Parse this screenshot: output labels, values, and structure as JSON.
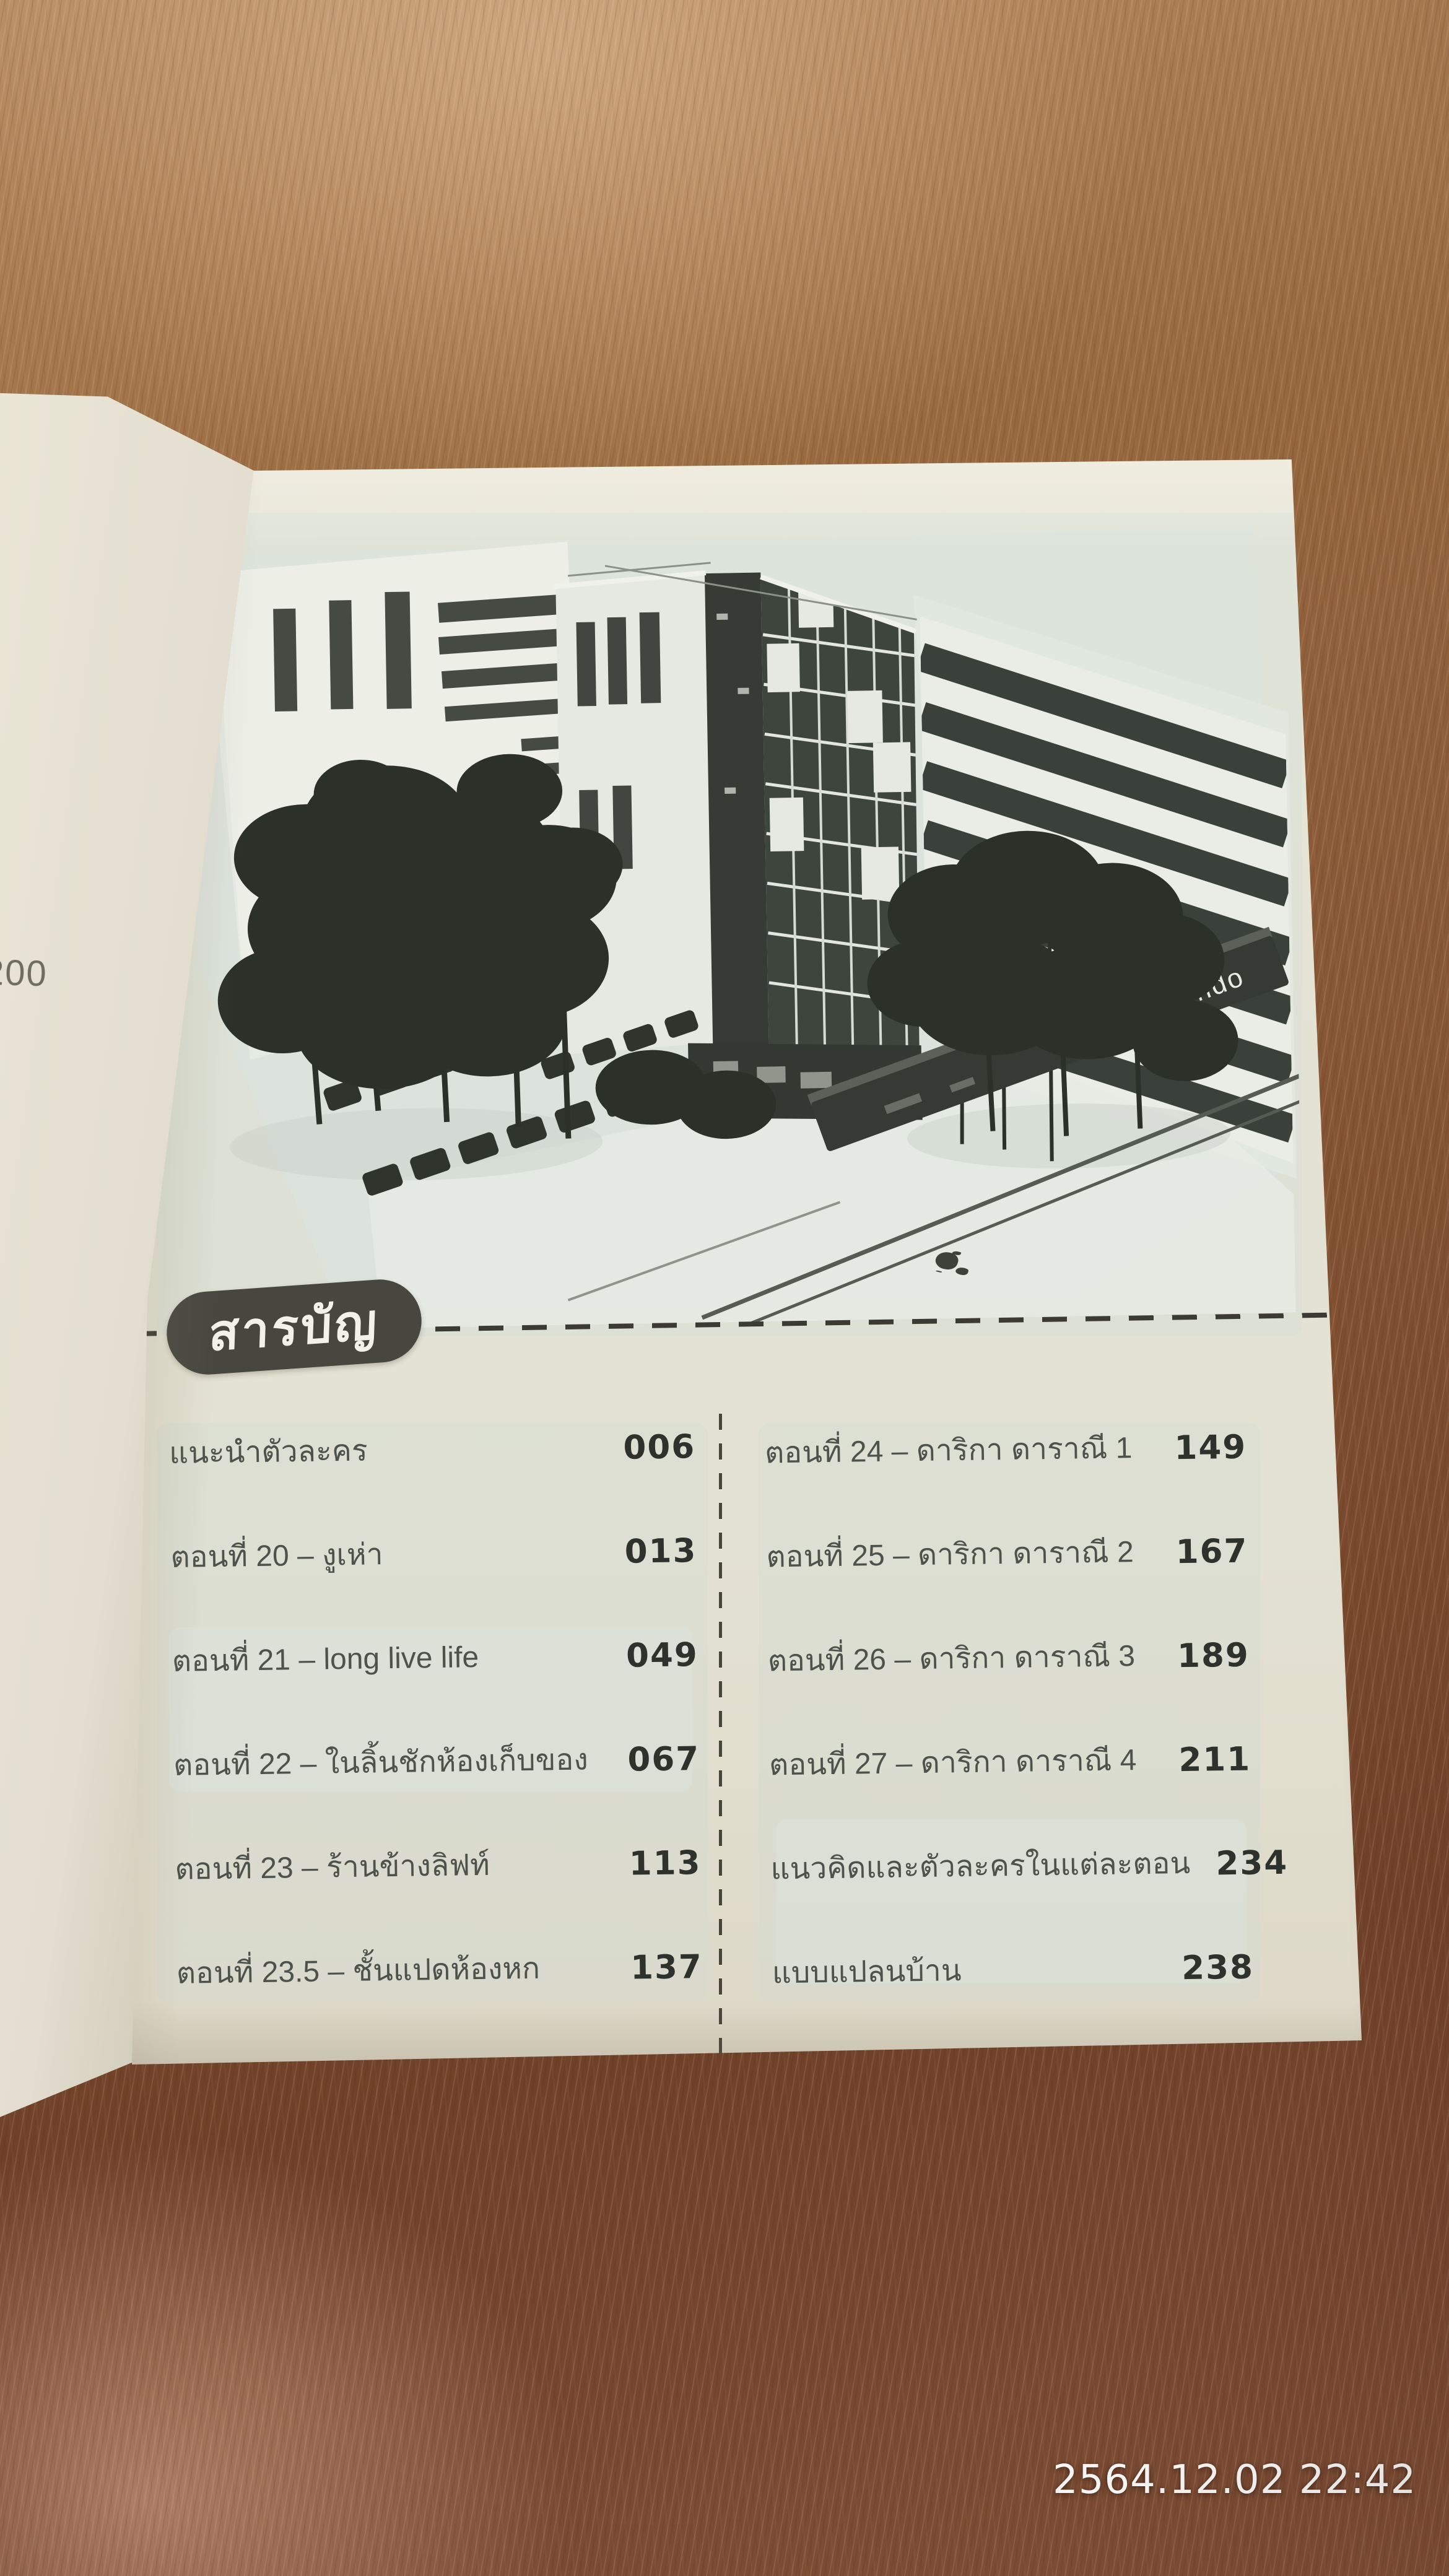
{
  "photo": {
    "timestamp": "2564.12.02 22:42"
  },
  "left_page": {
    "page_number": "200"
  },
  "page": {
    "header": {
      "title": "สารบัญ"
    },
    "illustration": {
      "sign_text": "condo"
    },
    "toc": {
      "left": [
        {
          "title": "แนะนำตัวละคร",
          "page": "006"
        },
        {
          "title": "ตอนที่ 20 – งูเห่า",
          "page": "013"
        },
        {
          "title": "ตอนที่ 21 – long live life",
          "page": "049"
        },
        {
          "title": "ตอนที่ 22 – ในลิ้นชักห้องเก็บของ",
          "page": "067"
        },
        {
          "title": "ตอนที่ 23 – ร้านข้างลิฟท์",
          "page": "113"
        },
        {
          "title": "ตอนที่ 23.5 – ชั้นแปดห้องหก",
          "page": "137"
        }
      ],
      "right": [
        {
          "title": "ตอนที่ 24 – ดาริกา ดาราณี 1",
          "page": "149"
        },
        {
          "title": "ตอนที่ 25 – ดาริกา ดาราณี 2",
          "page": "167"
        },
        {
          "title": "ตอนที่ 26 – ดาริกา ดาราณี 3",
          "page": "189"
        },
        {
          "title": "ตอนที่ 27 – ดาริกา ดาราณี 4",
          "page": "211"
        },
        {
          "title": "แนวคิดและตัวละครในแต่ละตอน",
          "page": "234"
        },
        {
          "title": "แบบแปลนบ้าน",
          "page": "238"
        }
      ]
    }
  },
  "colors": {
    "wood_light": "#b68c63",
    "wood_dark": "#6f4128",
    "page_paper": "#e6e3d4",
    "illustration_paper": "#dbe3dd",
    "illustration_ink": "#343a33",
    "pill_bg": "#474740",
    "pill_text": "#f2f2ea",
    "toc_text": "#4d534c",
    "toc_number": "#2d322c",
    "timestamp_text": "#ffffff"
  }
}
